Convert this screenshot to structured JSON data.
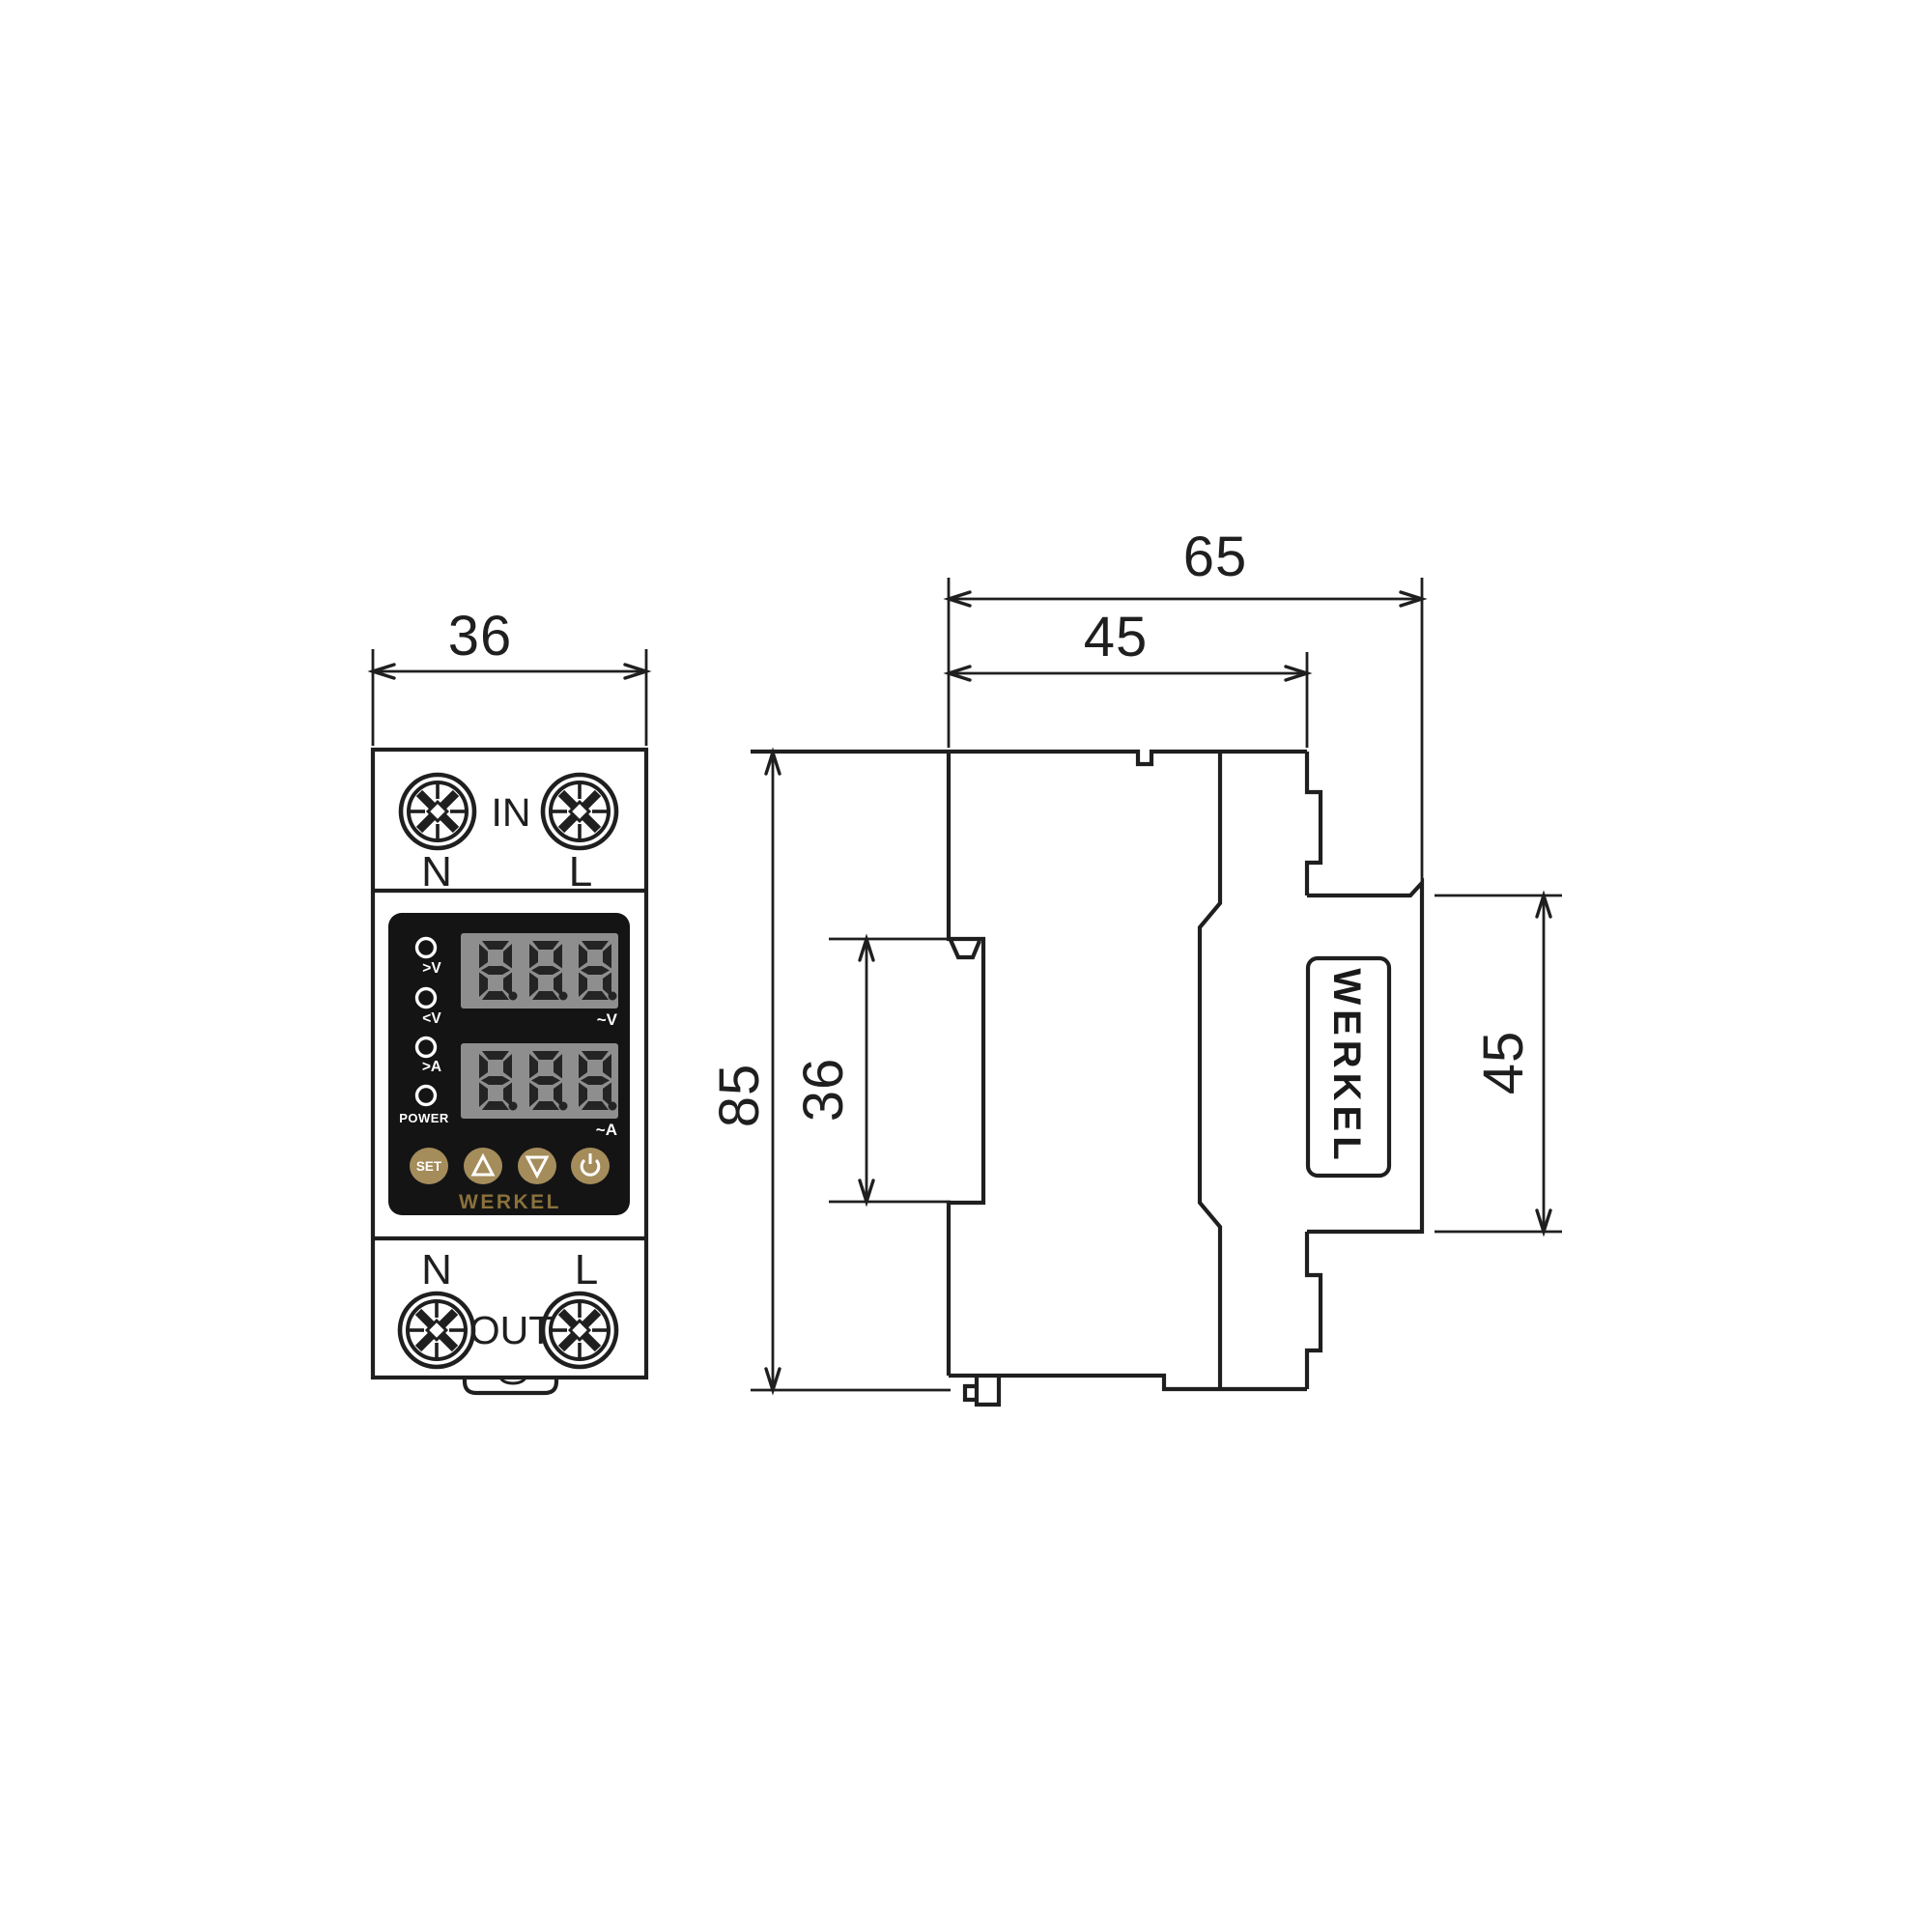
{
  "drawing": {
    "type": "technical-dimension-drawing",
    "views": [
      "front",
      "side"
    ],
    "units_note": "",
    "line_color": "#1f1f1f",
    "background": "#ffffff"
  },
  "dimensions": {
    "front_width": "36",
    "total_depth": "65",
    "body_depth": "45",
    "height": "85",
    "rail_section_height": "36",
    "front_block_height": "45"
  },
  "front_view": {
    "terminal_top": {
      "label": "IN",
      "n": "N",
      "l": "L"
    },
    "terminal_bottom": {
      "label": "OUT",
      "n": "N",
      "l": "L"
    },
    "panel": {
      "leds": [
        ">V",
        "<V",
        ">A",
        "POWER"
      ],
      "display_v": {
        "value": "888",
        "unit": "~V"
      },
      "display_a": {
        "value": "888",
        "unit": "~A"
      },
      "buttons": {
        "set": "SET",
        "up": "up-triangle",
        "down": "down-triangle",
        "power": "power-symbol"
      },
      "brand": "WERKEL"
    }
  },
  "side_view": {
    "brand": "WERKEL"
  },
  "colors": {
    "button": "#a58c5b",
    "brand_gold": "#8a713c",
    "panel_black": "#141414",
    "display_gray": "#8e8e8e",
    "digit": "#242424",
    "line": "#1f1f1f"
  }
}
